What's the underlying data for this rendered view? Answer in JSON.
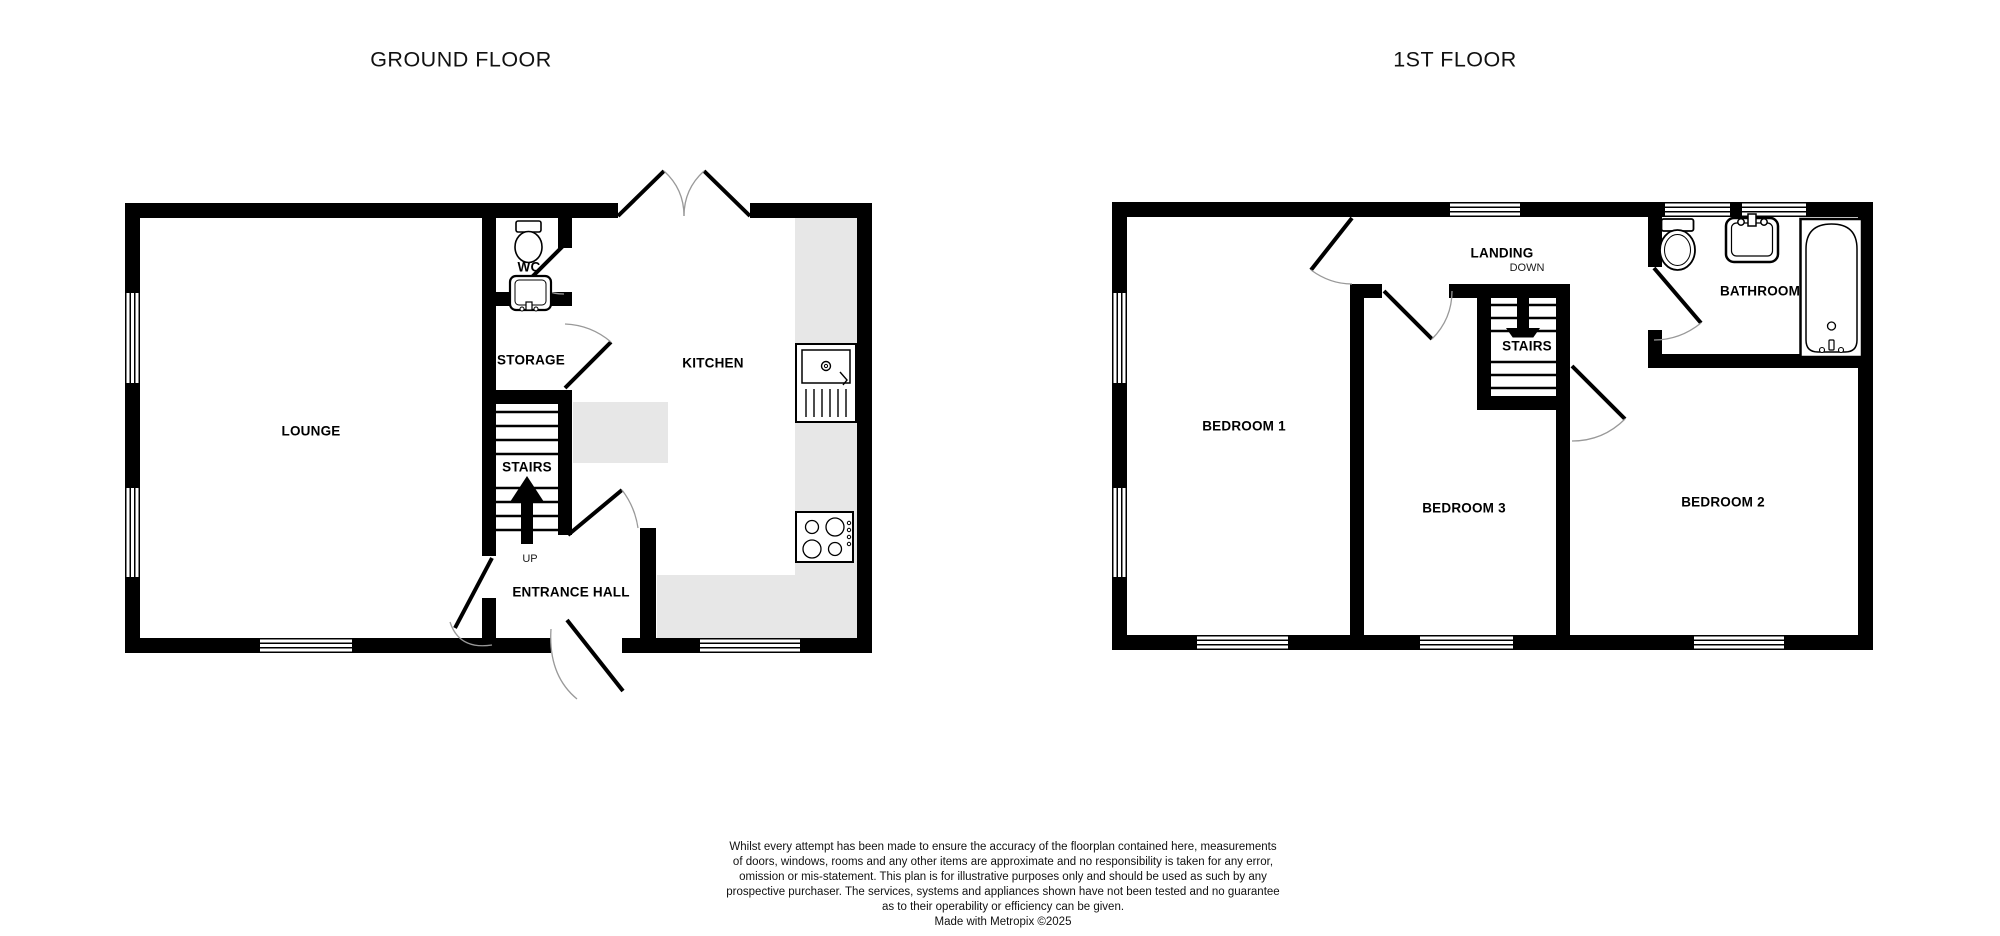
{
  "ground_floor": {
    "title": "GROUND FLOOR",
    "rooms": {
      "lounge": "LOUNGE",
      "wc": "WC",
      "storage": "STORAGE",
      "kitchen": "KITCHEN",
      "stairs": "STAIRS",
      "up": "UP",
      "entrance_hall": "ENTRANCE HALL"
    }
  },
  "first_floor": {
    "title": "1ST FLOOR",
    "rooms": {
      "bedroom1": "BEDROOM 1",
      "landing": "LANDING",
      "down": "DOWN",
      "stairs": "STAIRS",
      "bathroom": "BATHROOM",
      "bedroom3": "BEDROOM 3",
      "bedroom2": "BEDROOM 2"
    }
  },
  "disclaimer": {
    "lines": [
      "Whilst every attempt has been made to ensure the accuracy of the floorplan contained here, measurements",
      "of doors, windows, rooms and any other items are approximate and no responsibility is taken for any error,",
      "omission or mis-statement. This plan is for illustrative purposes only and should be used as such by any",
      "prospective purchaser. The services, systems and appliances shown have not been tested and no guarantee",
      "as to their operability or efficiency can be given.",
      "Made with Metropix ©2025"
    ]
  },
  "colors": {
    "wall": "#000000",
    "counter": "#e7e7e7",
    "arc": "#999999",
    "background": "#ffffff"
  }
}
